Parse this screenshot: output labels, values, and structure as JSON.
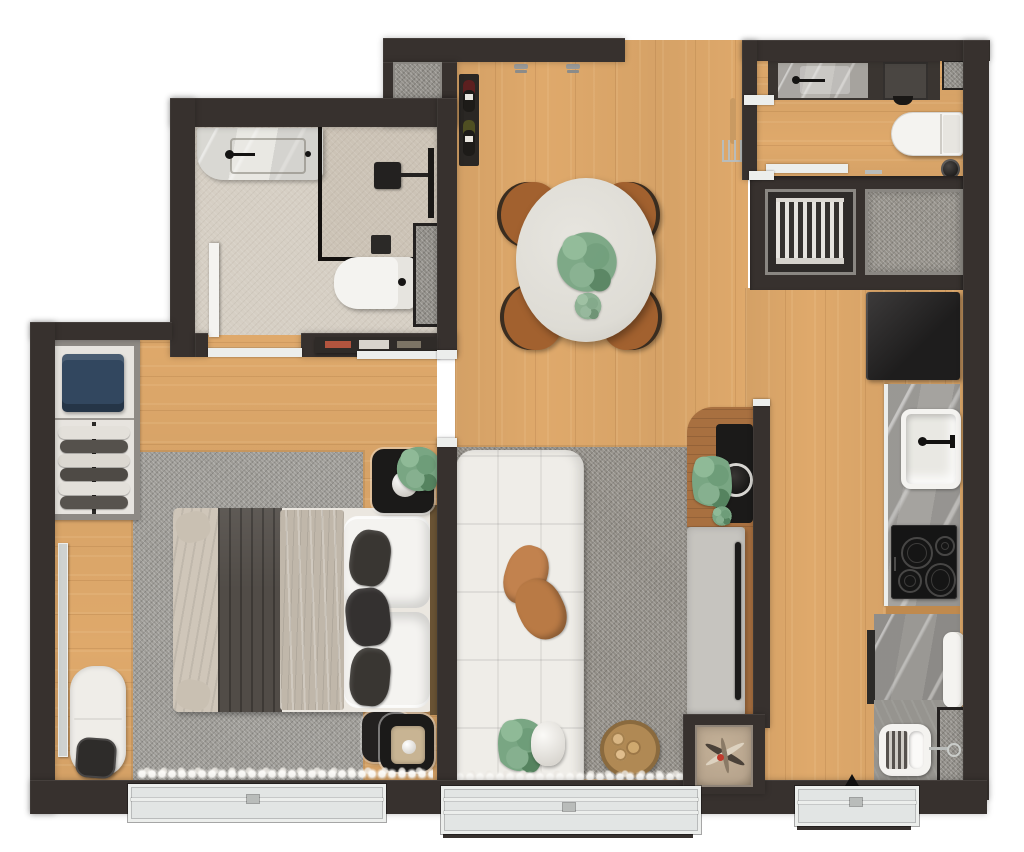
{
  "scene": {
    "type": "apartment-floor-plan-3d-render",
    "view": "top-down",
    "style": "photorealistic marketing floor plan, no text labels"
  },
  "palette": {
    "wall": "#37312e",
    "wood": "#dfa96b",
    "wood-dark": "#c08a4e",
    "walnut": "#a87040",
    "bath-floor": "#d6cfc4",
    "shower-floor": "#ccc3b6",
    "marble-light": "#e9e8e3",
    "marble-gray": "#a5a39f",
    "laundry-marble": "#b6b3ae",
    "cement": "#96948f",
    "gray-mat": "#8f8c86",
    "rug-bedroom": "#9c9a95",
    "rug-living": "#918d86",
    "fixture": "#f4f3f0",
    "glass": "#e2e5e4",
    "window-frame": "#eceeec",
    "fridge": "#262424",
    "cooktop": "#151515",
    "sofa": "#efede8",
    "pillow-tan": "#c2824e",
    "bed-blanket": "#514c47",
    "bed-duvet": "#c0b7aa",
    "bed-sheet": "#ebe7e0",
    "cushion-dark": "#393632",
    "chair-seat": "#a2612f",
    "chair-back": "#3a2d20",
    "table-top": "#dedcd5",
    "navy-clothes": "#32475f",
    "niche-bg": "#b7a48d",
    "black-unit": "#1b1a19",
    "plant-green": "#79a683"
  },
  "rooms": [
    {
      "name": "bathroom",
      "furniture": [
        "vanity-with-sink",
        "black-faucet",
        "glass-shower-enclosure",
        "shower-head",
        "toilet",
        "wall-niche-mat",
        "open-door"
      ]
    },
    {
      "name": "entry-hall-dining",
      "furniture": [
        "entry-door-opening",
        "wall-hooks",
        "coat-rack",
        "wine-rack-with-bottles",
        "oval-dining-table",
        "centerpiece-plant",
        "dining-chair",
        "dining-chair",
        "dining-chair",
        "dining-chair",
        "console-sideboard"
      ]
    },
    {
      "name": "laundry",
      "furniture": [
        "laundry-counter",
        "counter-faucet",
        "dark-basin",
        "washer-tub",
        "corner-mat",
        "wall-shelf",
        "small-stool",
        "waste-bin"
      ]
    },
    {
      "name": "service-area",
      "furniture": [
        "ac-condenser-grille",
        "floor-mat"
      ]
    },
    {
      "name": "kitchen",
      "furniture": [
        "refrigerator",
        "stone-counter",
        "kitchen-sink",
        "sink-faucet",
        "cooktop-4-burners",
        "lower-counter",
        "utility-sink",
        "open-white-door",
        "side-floor-mat",
        "kitchen-window"
      ]
    },
    {
      "name": "living-room",
      "furniture": [
        "modular-sofa",
        "throw-pillows",
        "area-rug",
        "tv-divider-panel",
        "tv",
        "black-side-counter",
        "potted-plant",
        "floor-plant",
        "log-basket",
        "dried-flower-niche",
        "sheer-curtain",
        "window"
      ]
    },
    {
      "name": "bedroom",
      "furniture": [
        "double-bed",
        "dark-blanket",
        "duvet",
        "pillows",
        "accent-cushions",
        "area-rug",
        "nightstand-with-lamp-and-plant",
        "nightstand-with-tray",
        "open-wardrobe",
        "folded-blue-clothes",
        "hanging-clothes",
        "full-length-mirror",
        "chaise-bench",
        "black-pouf",
        "sheer-curtain",
        "window"
      ]
    }
  ]
}
